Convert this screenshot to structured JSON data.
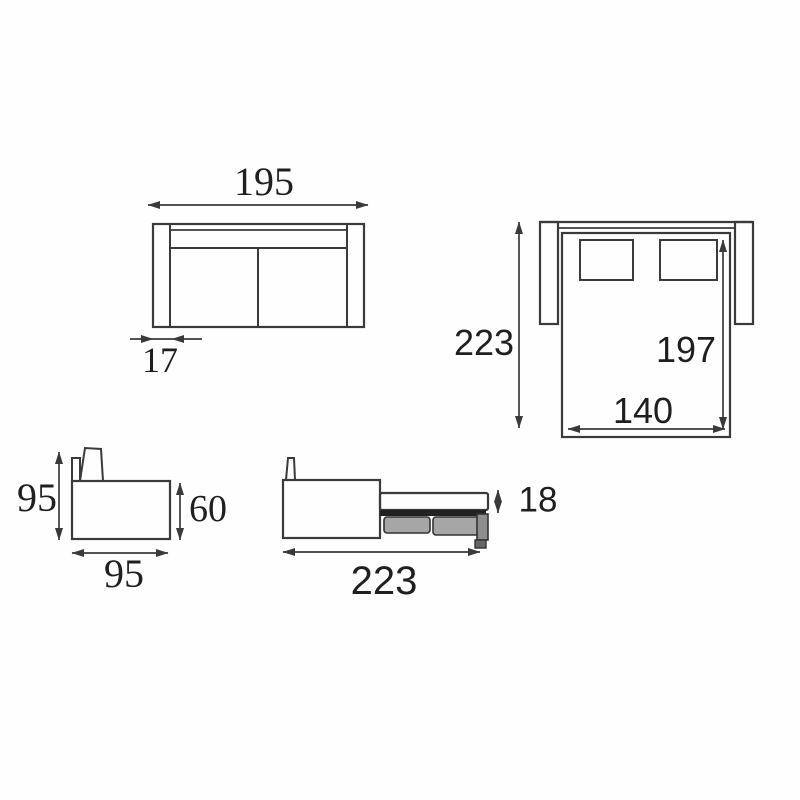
{
  "colors": {
    "background": "#fefefe",
    "line": "#3a3a3a",
    "text": "#1f1f1f",
    "mechanism_gray": "#a6a6a6",
    "mechanism_dark": "#222222"
  },
  "views": {
    "sofa_plan": {
      "name": "Sofa top view (closed)",
      "overall_width": "195",
      "armrest_width": "17"
    },
    "bed_plan": {
      "name": "Sofa-bed top view (opened)",
      "overall_depth": "223",
      "bed_length": "197",
      "bed_width": "140"
    },
    "sofa_side": {
      "name": "Sofa side view (closed)",
      "overall_height": "95",
      "armrest_height": "60",
      "overall_depth": "95"
    },
    "bed_side": {
      "name": "Sofa-bed side view (opened)",
      "mattress_thickness": "18",
      "open_depth": "223"
    }
  }
}
